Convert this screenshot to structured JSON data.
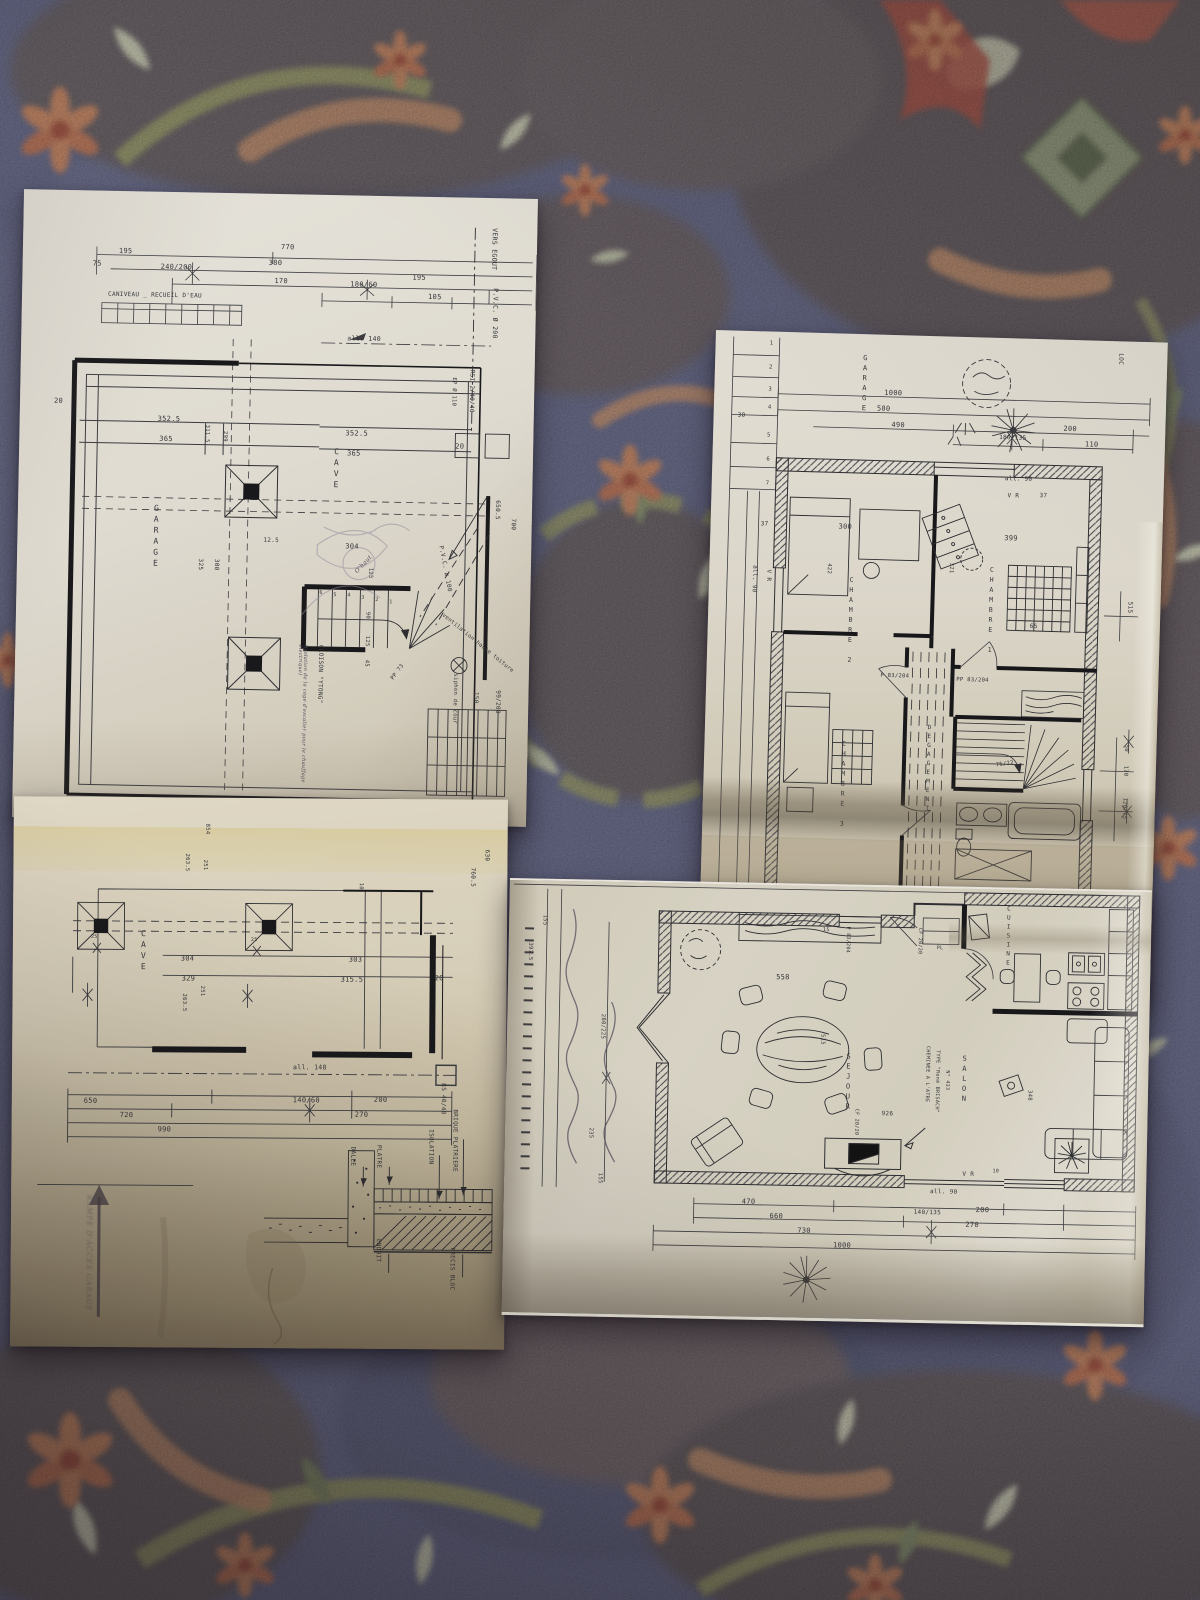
{
  "scene": {
    "subject": "four architectural floor plan sheets photographed on a paisley fabric tablecloth"
  },
  "palette": {
    "fabric_blue": "#5b6088",
    "fabric_charcoal": "#5c545e",
    "fabric_olive": "#8d9064",
    "fabric_terracotta": "#c07b58",
    "fabric_red": "#a4423a",
    "fabric_cream": "#c9ccb6",
    "paper_light": "#e9e7e1",
    "paper_tan": "#c9bfa4",
    "ink": "#32333a"
  },
  "sheetA": {
    "rooms": {
      "cave": "CAVE",
      "garage": "GARAGE"
    },
    "notes": {
      "caniveau": "CANIVEAU _ RECUEIL D'EAU",
      "vers_egout": "VERS EGOUT",
      "pvc200": "P.V.C. Ø 200",
      "rsi": "RSI 2/40/40",
      "ep110": "EP Ø 110",
      "pvc100": "P.V.C. ø 100",
      "vent": "ventilation haute toiture",
      "siphon": "siphon de cour",
      "cloison": "CLOISON \"YTONG\"",
      "cloison_note": "(isolation de la cage d'escalier pour le chauffage électrique)",
      "pp73": "PP 73",
      "ohaut": "O'haut"
    },
    "dims": {
      "d195a": "195",
      "d770": "770",
      "d75": "75",
      "d240": "240/200",
      "d380": "380",
      "d170": "170",
      "d180": "180/60",
      "d195b": "195",
      "d105": "105",
      "dall140": "all. 140",
      "d20l": "20",
      "d3525a": "352.5",
      "d365a": "365",
      "d3115": "311.5",
      "d299": "299",
      "d3525b": "352.5",
      "d365b": "365",
      "d20r": "20",
      "d6505": "650.5",
      "d700": "700",
      "d125s": "12.5",
      "d304": "304",
      "d125": "125",
      "d325": "325",
      "d300": "300",
      "d90": "90",
      "d125b": "125",
      "d45": "45",
      "d150": "150",
      "d99": "99/200"
    },
    "stair": [
      "1",
      "2",
      "3",
      "4",
      "5",
      "6"
    ]
  },
  "sheetB": {
    "rooms": {
      "cave": "CAVE"
    },
    "detail": {
      "dalle": "DALLE",
      "platre": "PLATRE",
      "isolation": "ISOLATION",
      "brique": "BRIQUE PLATRIERE",
      "enduit": "ENDUIT",
      "precis": "PRECIS BLOC"
    },
    "notes": {
      "rampe": "RAMPE D'ACCES GARAGE",
      "rs": "RS 40/40",
      "all140": "all. 140"
    },
    "dims": {
      "d854": "854",
      "d251a": "251",
      "d2635a": "263.5",
      "d304": "304",
      "d329": "329",
      "d251b": "251",
      "d2635b": "263.5",
      "d303": "303",
      "d3155": "315.5",
      "d10": "10",
      "d20": "20",
      "d630": "630",
      "d7605": "760.5",
      "d650": "650",
      "d720": "720",
      "d990": "990",
      "d140": "140/60",
      "d200": "200",
      "d270": "270",
      "d25a": "25",
      "d25b": "25"
    }
  },
  "sheetC": {
    "rooms": {
      "garage": "GARAGE",
      "ch1": "CHAMBRE 1",
      "ch2": "CHAMBRE 2",
      "ch3": "CHAMBRE 3",
      "deg": "DEGAGEMENT"
    },
    "notes": {
      "loc": "LOC",
      "vra": "V R",
      "vrb": "V R",
      "all90a": "all. 90",
      "all90b": "all. 90",
      "p83": "P 83/204",
      "pp83": "PP 83/204",
      "d7522": "75/22"
    },
    "dims": {
      "d30": "30",
      "d37a": "37",
      "d37b": "37",
      "d1000": "1000",
      "d580": "580",
      "d490": "490",
      "d200": "200",
      "d180135": "180/135",
      "d110": "110",
      "d300": "300",
      "d422": "422",
      "d399": "399",
      "d321": "321",
      "d65": "65",
      "d515": "515",
      "d170": "170",
      "d12075": "120/75",
      "d50": "50"
    },
    "steps": [
      "1",
      "2",
      "3",
      "4",
      "5",
      "6",
      "7"
    ]
  },
  "sheetD": {
    "rooms": {
      "sejour": "SEJOUR",
      "salon": "SALON",
      "cuisine": "CUISINE"
    },
    "notes": {
      "chem1": "CHEMINEE A L'ATRE",
      "chem2": "TYPE \"René BRISACH\"",
      "chem3": "N° 433",
      "cf1": "CF 20/20",
      "cf2": "CF 20/20",
      "p83": "P 83/204",
      "pl": "PL",
      "vra": "V R",
      "d10": "10",
      "d15": "15",
      "all90": "all. 90"
    },
    "dims": {
      "d155a": "155",
      "d3975": "397.5",
      "d280225": "280/225",
      "d235": "235",
      "d155b": "155",
      "d558": "558",
      "d515": "515",
      "d926": "926",
      "d348": "348",
      "d470": "470",
      "d660": "660",
      "d730": "730",
      "d1000": "1000",
      "d140135": "140/135",
      "d200": "200",
      "d270": "270"
    }
  }
}
